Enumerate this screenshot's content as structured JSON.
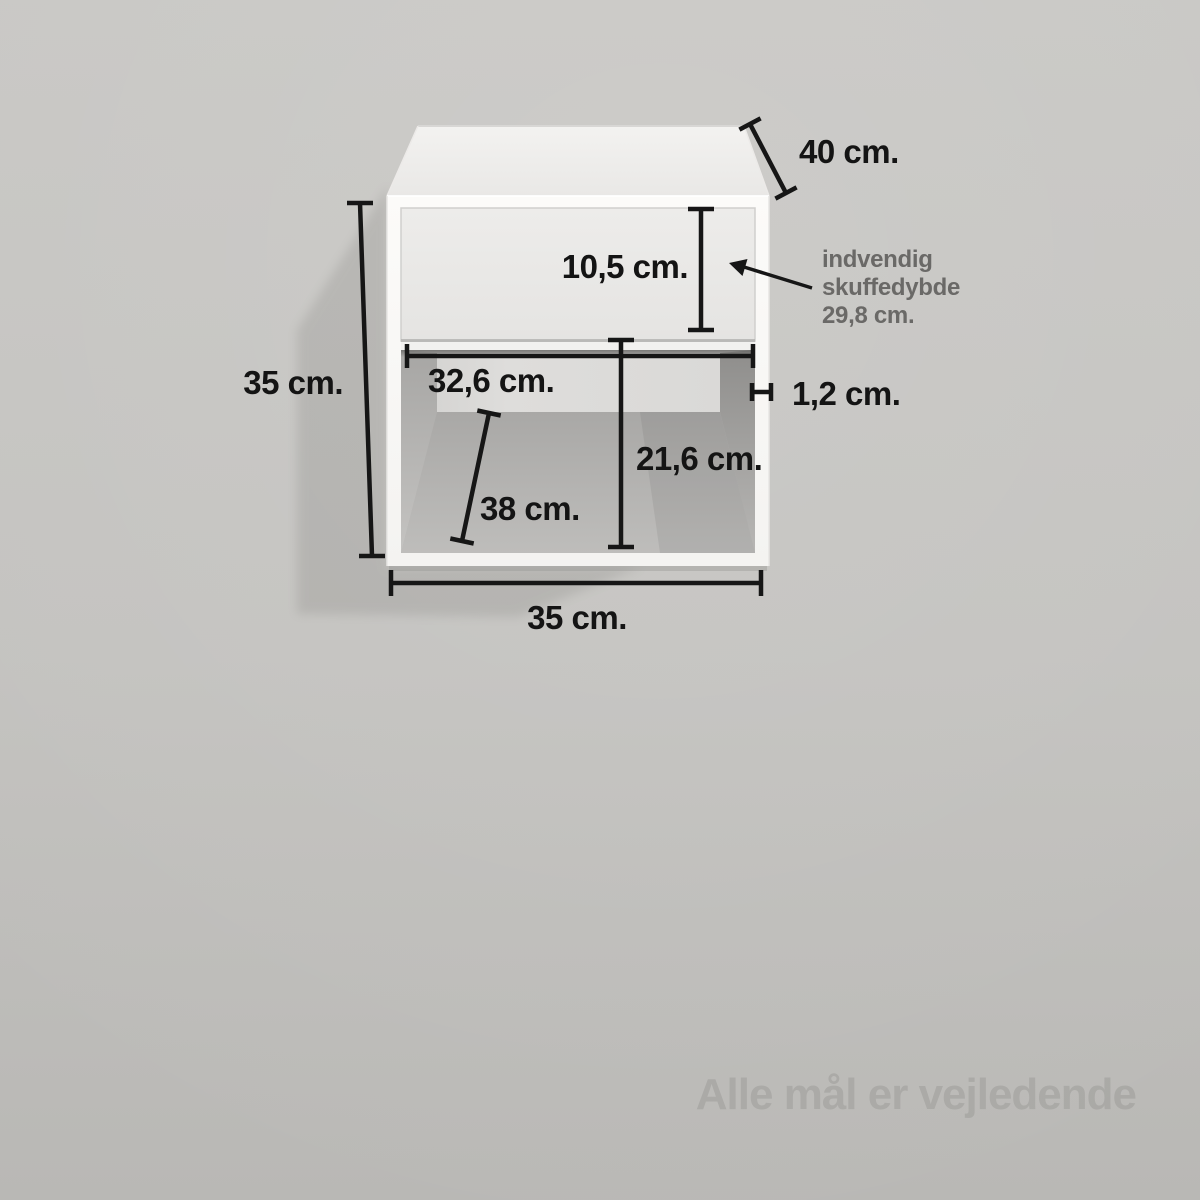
{
  "diagram": {
    "dimensions": [
      {
        "id": "depth",
        "label": "40 cm."
      },
      {
        "id": "drawer_front_height",
        "label": "10,5 cm."
      },
      {
        "id": "height",
        "label": "35 cm."
      },
      {
        "id": "inner_width",
        "label": "32,6 cm."
      },
      {
        "id": "panel_thickness",
        "label": "1,2 cm."
      },
      {
        "id": "inner_height",
        "label": "21,6 cm."
      },
      {
        "id": "inner_depth",
        "label": "38 cm."
      },
      {
        "id": "width",
        "label": "35 cm."
      }
    ],
    "drawer_note": {
      "line1": "indvendig",
      "line2": "skuffedybde",
      "line3": "29,8 cm."
    },
    "watermark": "Alle mål er vejledende",
    "colors": {
      "background_top": "#c8c7c4",
      "background_bottom": "#b9b8b5",
      "wall_shadow": "#b1b0ad",
      "cabinet_white": "#fbfaf8",
      "cabinet_top_face": "#efeeec",
      "drawer_front": "#eae9e7",
      "interior_back_wall": "#dbdad8",
      "interior_floor": "#b2b1af",
      "dimension_line": "#161616",
      "dimension_text": "#141414",
      "note_text": "#6a6967",
      "watermark_text": "#a7a6a3"
    }
  }
}
